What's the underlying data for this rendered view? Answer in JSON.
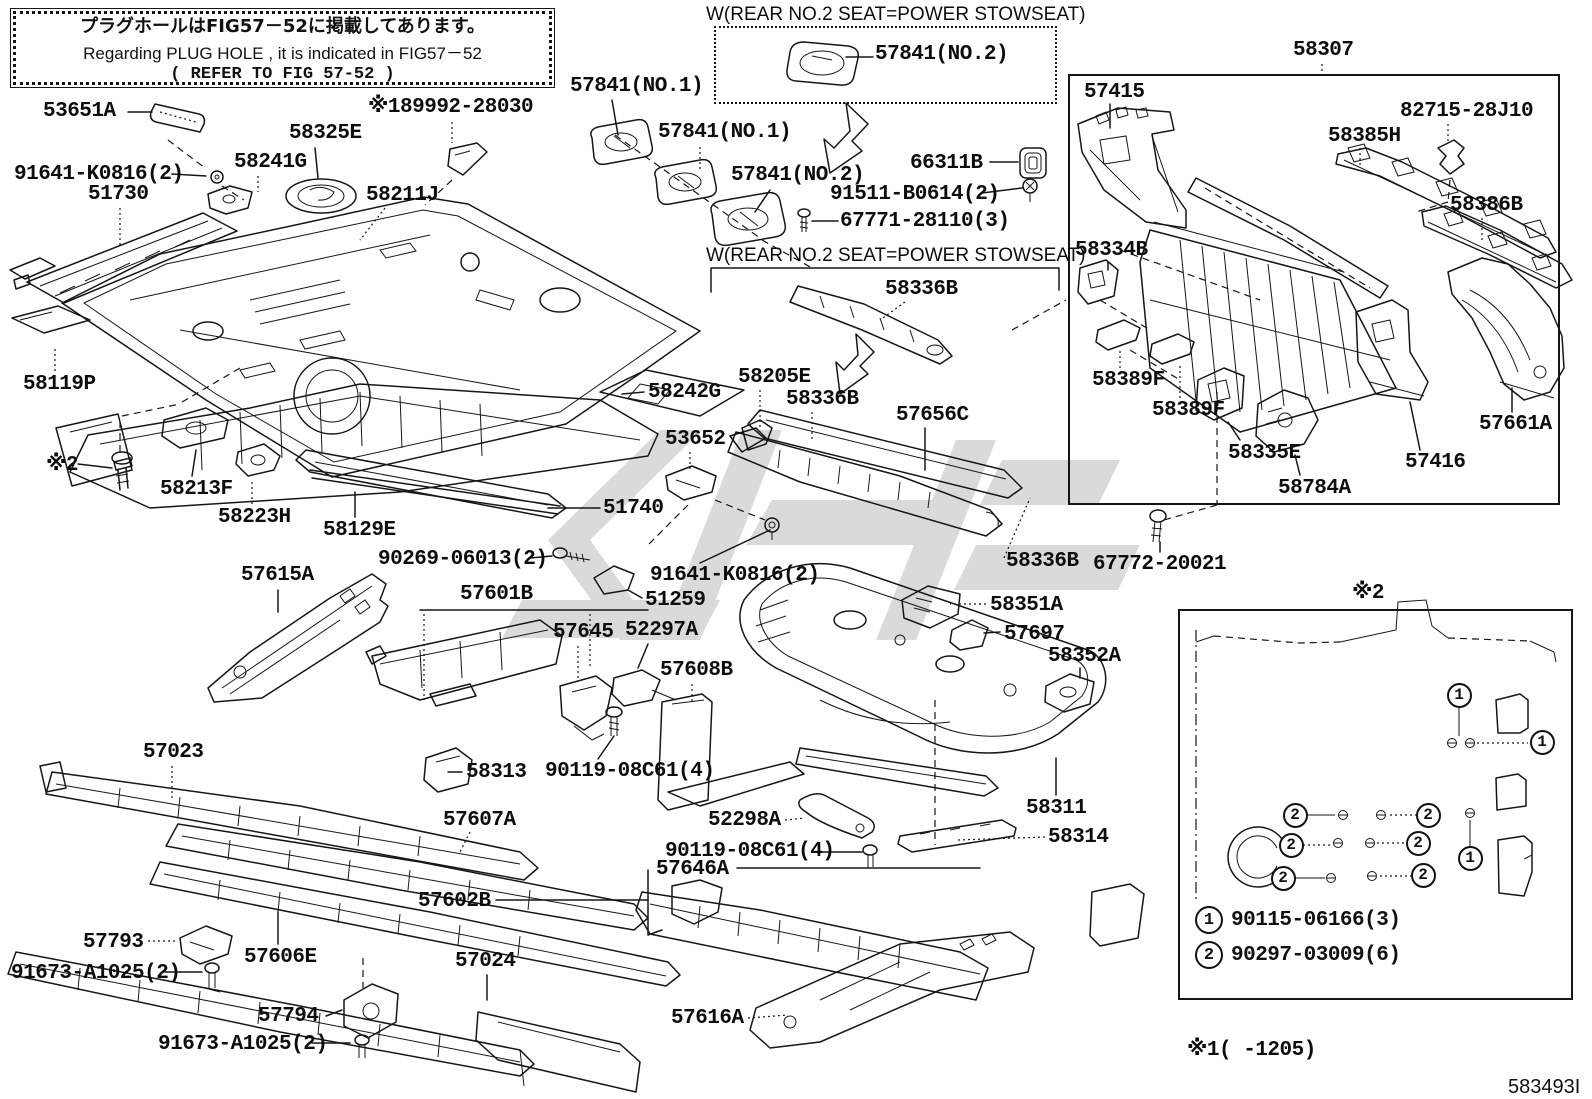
{
  "info_box": {
    "line1_jp": "プラグホールはFIG57－52に掲載してあります。",
    "line2_en": "Regarding  PLUG  HOLE , it  is  indicated  in  FIG57－52",
    "line3_ref": "(     REFER TO FIG 57-52          )"
  },
  "captions": {
    "stowseat_top": "W(REAR NO.2 SEAT=POWER STOWSEAT)",
    "stowseat_bottom": "W(REAR NO.2 SEAT=POWER STOWSEAT)"
  },
  "boxes": {
    "assembly_label": "58307",
    "note_caption": "※2"
  },
  "legend": [
    {
      "num": "1",
      "part": "90115-06166(3)"
    },
    {
      "num": "2",
      "part": "90297-03009(6)"
    }
  ],
  "note_markers": [
    {
      "num": "1",
      "x": 1459,
      "y": 695
    },
    {
      "num": "1",
      "x": 1542,
      "y": 742
    },
    {
      "num": "1",
      "x": 1470,
      "y": 858
    },
    {
      "num": "2",
      "x": 1295,
      "y": 815
    },
    {
      "num": "2",
      "x": 1428,
      "y": 815
    },
    {
      "num": "2",
      "x": 1291,
      "y": 845
    },
    {
      "num": "2",
      "x": 1418,
      "y": 843
    },
    {
      "num": "2",
      "x": 1283,
      "y": 878
    },
    {
      "num": "2",
      "x": 1423,
      "y": 875
    }
  ],
  "footer": {
    "applicability": "※1(        -1205)",
    "figure_code": "583493I"
  },
  "part_labels": [
    {
      "t": "53651A",
      "x": 43,
      "y": 101
    },
    {
      "t": "91641-K0816(2)",
      "x": 14,
      "y": 164
    },
    {
      "t": "51730",
      "x": 88,
      "y": 184
    },
    {
      "t": "58241G",
      "x": 234,
      "y": 152
    },
    {
      "t": "58325E",
      "x": 289,
      "y": 123
    },
    {
      "t": "58211J",
      "x": 366,
      "y": 185
    },
    {
      "t": "※189992-28030",
      "x": 368,
      "y": 97
    },
    {
      "t": "57841(NO.1)",
      "x": 570,
      "y": 76
    },
    {
      "t": "57841(NO.1)",
      "x": 658,
      "y": 122
    },
    {
      "t": "57841(NO.2)",
      "x": 731,
      "y": 165
    },
    {
      "t": "57841(NO.2)",
      "x": 875,
      "y": 44
    },
    {
      "t": "66311B",
      "x": 910,
      "y": 153
    },
    {
      "t": "91511-B0614(2)",
      "x": 830,
      "y": 184
    },
    {
      "t": "67771-28110(3)",
      "x": 840,
      "y": 211
    },
    {
      "t": "58336B",
      "x": 885,
      "y": 279
    },
    {
      "t": "58205E",
      "x": 738,
      "y": 367
    },
    {
      "t": "58336B",
      "x": 786,
      "y": 389
    },
    {
      "t": "57656C",
      "x": 896,
      "y": 405
    },
    {
      "t": "58242G",
      "x": 648,
      "y": 382
    },
    {
      "t": "53652",
      "x": 665,
      "y": 429
    },
    {
      "t": "51740",
      "x": 603,
      "y": 498
    },
    {
      "t": "90269-06013(2)",
      "x": 378,
      "y": 549
    },
    {
      "t": "91641-K0816(2)",
      "x": 650,
      "y": 565
    },
    {
      "t": "51259",
      "x": 645,
      "y": 590
    },
    {
      "t": "58119P",
      "x": 23,
      "y": 374
    },
    {
      "t": "※2",
      "x": 46,
      "y": 455
    },
    {
      "t": "58213F",
      "x": 160,
      "y": 479
    },
    {
      "t": "58223H",
      "x": 218,
      "y": 507
    },
    {
      "t": "58129E",
      "x": 323,
      "y": 520
    },
    {
      "t": "57615A",
      "x": 241,
      "y": 565
    },
    {
      "t": "57601B",
      "x": 460,
      "y": 584
    },
    {
      "t": "57645",
      "x": 553,
      "y": 622
    },
    {
      "t": "52297A",
      "x": 625,
      "y": 620
    },
    {
      "t": "57608B",
      "x": 660,
      "y": 660
    },
    {
      "t": "57023",
      "x": 143,
      "y": 742
    },
    {
      "t": "58313",
      "x": 466,
      "y": 762
    },
    {
      "t": "90119-08C61(4)",
      "x": 545,
      "y": 761
    },
    {
      "t": "57607A",
      "x": 443,
      "y": 810
    },
    {
      "t": "52298A",
      "x": 708,
      "y": 810
    },
    {
      "t": "58311",
      "x": 1026,
      "y": 798
    },
    {
      "t": "58314",
      "x": 1048,
      "y": 827
    },
    {
      "t": "90119-08C61(4)",
      "x": 665,
      "y": 841
    },
    {
      "t": "57646A",
      "x": 656,
      "y": 859
    },
    {
      "t": "57602B",
      "x": 418,
      "y": 891
    },
    {
      "t": "57793",
      "x": 83,
      "y": 932
    },
    {
      "t": "91673-A1025(2)",
      "x": 11,
      "y": 963
    },
    {
      "t": "57606E",
      "x": 244,
      "y": 947
    },
    {
      "t": "57794",
      "x": 258,
      "y": 1006
    },
    {
      "t": "91673-A1025(2)",
      "x": 158,
      "y": 1034
    },
    {
      "t": "57024",
      "x": 455,
      "y": 951
    },
    {
      "t": "57616A",
      "x": 671,
      "y": 1008
    },
    {
      "t": "58307",
      "x": 1293,
      "y": 40
    },
    {
      "t": "57415",
      "x": 1084,
      "y": 82
    },
    {
      "t": "82715-28J10",
      "x": 1400,
      "y": 101
    },
    {
      "t": "58385H",
      "x": 1328,
      "y": 126
    },
    {
      "t": "58386B",
      "x": 1450,
      "y": 195
    },
    {
      "t": "58334B",
      "x": 1075,
      "y": 240
    },
    {
      "t": "58389F",
      "x": 1092,
      "y": 370
    },
    {
      "t": "58389F",
      "x": 1152,
      "y": 400
    },
    {
      "t": "58335E",
      "x": 1228,
      "y": 443
    },
    {
      "t": "58784A",
      "x": 1278,
      "y": 478
    },
    {
      "t": "57416",
      "x": 1405,
      "y": 452
    },
    {
      "t": "57661A",
      "x": 1479,
      "y": 414
    },
    {
      "t": "58336B",
      "x": 1006,
      "y": 551
    },
    {
      "t": "67772-20021",
      "x": 1093,
      "y": 554
    },
    {
      "t": "58351A",
      "x": 990,
      "y": 595
    },
    {
      "t": "57697",
      "x": 1004,
      "y": 624
    },
    {
      "t": "58352A",
      "x": 1048,
      "y": 646
    }
  ]
}
